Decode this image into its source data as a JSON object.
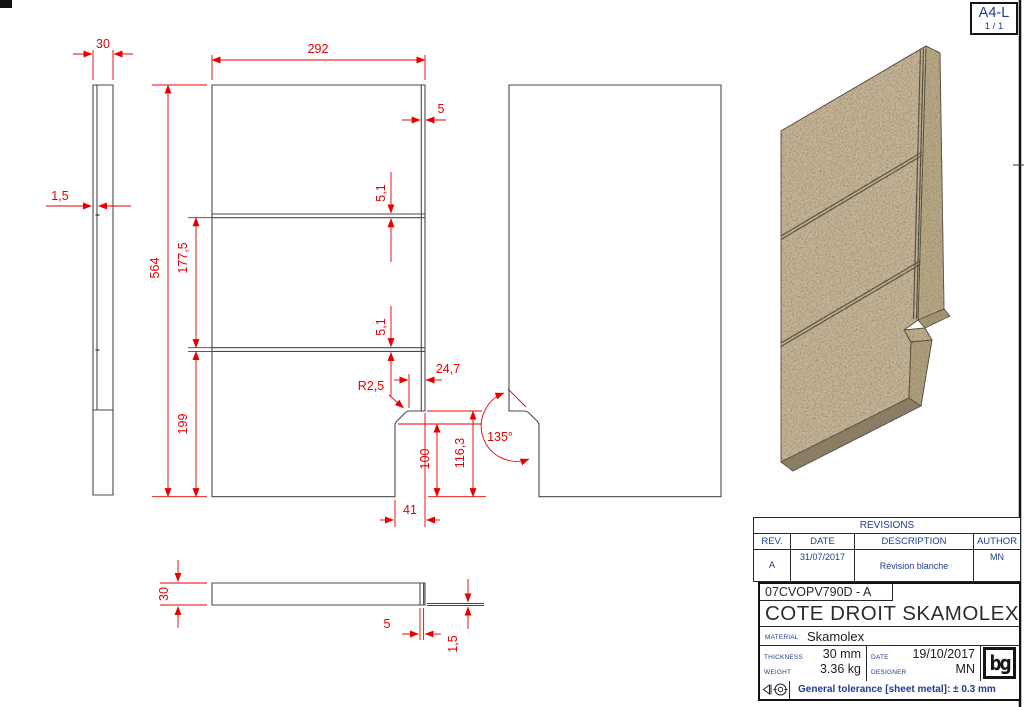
{
  "sheet": {
    "format": "A4-L",
    "page": "1 / 1"
  },
  "revisions": {
    "title": "REVISIONS",
    "columns": {
      "rev": "REV.",
      "date": "DATE",
      "description": "DESCRIPTION",
      "author": "AUTHOR"
    },
    "rows": [
      {
        "rev": "A",
        "date": "31/07/2017",
        "description": "Révision blanche",
        "author": "MN"
      }
    ]
  },
  "title_block": {
    "part_number": "07CVOPV790D - A",
    "title": "COTE DROIT SKAMOLEX",
    "material_label": "MATERIAL",
    "material": "Skamolex",
    "thickness_label": "THICKNESS",
    "thickness": "30 mm",
    "weight_label": "WEIGHT",
    "weight": "3.36 kg",
    "date_label": "DATE",
    "date": "19/10/2017",
    "designer_label": "DESIGNER",
    "designer": "MN",
    "tolerance": "General tolerance [sheet metal]: ± 0.3 mm",
    "logo": "bg"
  },
  "dimensions": {
    "side_thickness": "30",
    "side_groove_depth": "1,5",
    "front_width": "292",
    "edge_groove_offset": "5",
    "groove_width_top": "5,1",
    "groove_width_mid": "5,1",
    "overall_height": "564",
    "segment_mid": "177,5",
    "segment_bottom": "199",
    "notch_top_offset": "24,7",
    "fillet_radius": "R2,5",
    "notch_inner_height": "100",
    "notch_height": "116,3",
    "notch_width": "41",
    "notch_angle": "135°",
    "plan_thickness": "30",
    "plan_groove_width": "5",
    "plan_groove_depth": "1,5"
  },
  "colors": {
    "dimension_red": "#e60000",
    "annotation_navy": "#1e3d8f",
    "board_tan": "#cab899"
  }
}
